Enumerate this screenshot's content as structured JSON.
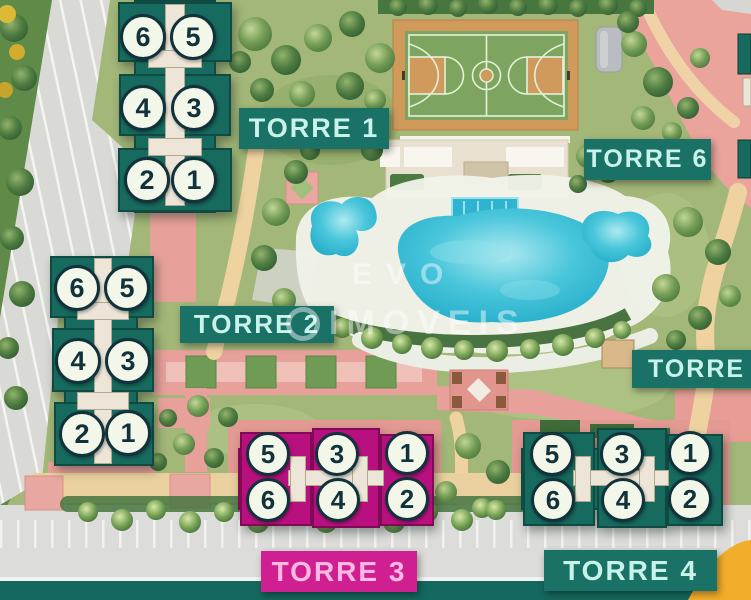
{
  "watermark": {
    "line1": "EVO",
    "line2": "IMOVEIS"
  },
  "towers": {
    "torre1": {
      "label": "TORRE 1",
      "units": [
        "6",
        "5",
        "4",
        "3",
        "2",
        "1"
      ]
    },
    "torre2": {
      "label": "TORRE 2",
      "units": [
        "6",
        "5",
        "4",
        "3",
        "2",
        "1"
      ]
    },
    "torre3": {
      "label": "TORRE 3",
      "units": [
        "5",
        "3",
        "1",
        "6",
        "4",
        "2"
      ]
    },
    "torre4": {
      "label": "TORRE 4",
      "units": [
        "5",
        "3",
        "1",
        "6",
        "4",
        "2"
      ]
    },
    "torre5": {
      "label": "TORRE"
    },
    "torre6": {
      "label": "TORRE 6"
    }
  },
  "colors": {
    "tower_teal": "#176a5e",
    "tower_magenta": "#b8117f",
    "label_teal_bg": "#1a7165",
    "label_teal_text": "#c9f2ea",
    "label_magenta_bg": "#cf1f90",
    "label_magenta_text": "#ffb9e2",
    "unit_circle_fill": "#f3f7e9",
    "unit_circle_ink": "#11323b",
    "pool_water": "#3fc0d8",
    "court_orange": "#d09a5b",
    "court_green": "#7ea55f",
    "path_sand": "#eed2a0",
    "road_pink": "#e7a19a",
    "parking_gray": "#dcdcda",
    "bottom_band_teal": "#15685d",
    "accent_yellow": "#f2ae2b"
  }
}
